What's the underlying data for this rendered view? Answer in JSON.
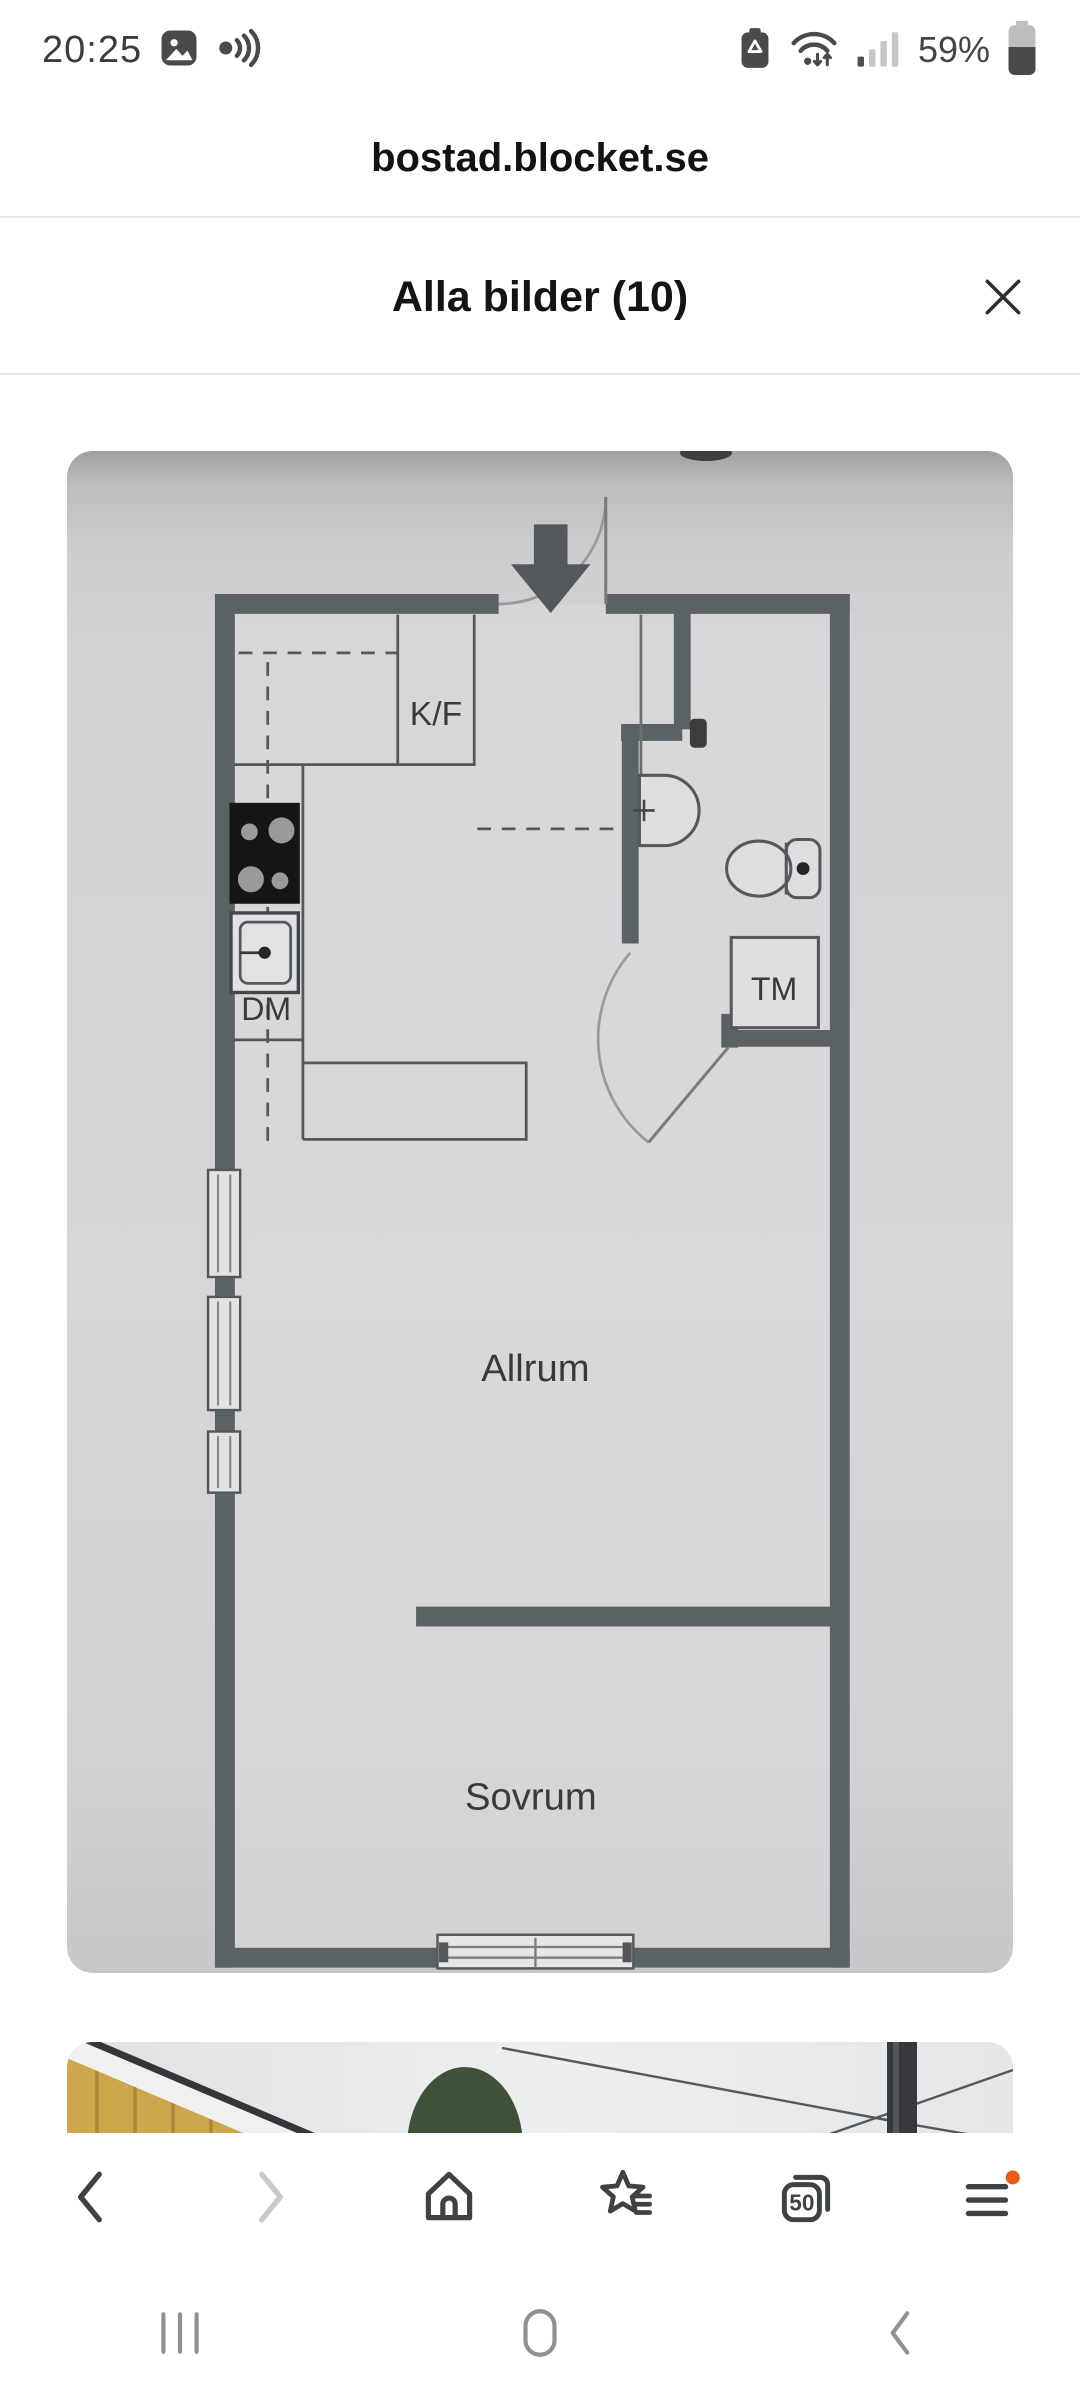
{
  "status_bar": {
    "time": "20:25",
    "battery_percent": "59%",
    "left_icons": [
      "gallery-icon",
      "sound-wave-icon"
    ],
    "right_icons": [
      "battery-saver-icon",
      "wifi-arrows-icon",
      "signal-bars-icon",
      "battery-icon"
    ]
  },
  "url_bar": {
    "url": "bostad.blocket.se",
    "icons": [
      "bookmark-star-icon",
      "secure-lock-icon",
      "reload-icon"
    ]
  },
  "gallery_header": {
    "title": "Alla bilder (10)",
    "close_icon": "close-icon"
  },
  "floor_plan": {
    "labels": {
      "kf": "K/F",
      "dm": "DM",
      "tm": "TM",
      "allrum": "Allrum",
      "sovrum": "Sovrum"
    }
  },
  "toolbar": {
    "tab_count": "50",
    "icons": [
      "back-icon",
      "forward-icon",
      "home-icon",
      "bookmarks-icon",
      "tabs-icon",
      "menu-icon"
    ]
  },
  "system_nav": {
    "icons": [
      "recents-icon",
      "home-pill-icon",
      "back-chevron-icon"
    ]
  },
  "colors": {
    "wall": "#5a6266",
    "plan_paper": "#d5d5d7",
    "accent_orange": "#ee5a12",
    "icon_dark": "#3f4245",
    "status_icon": "#4a4a4c"
  }
}
